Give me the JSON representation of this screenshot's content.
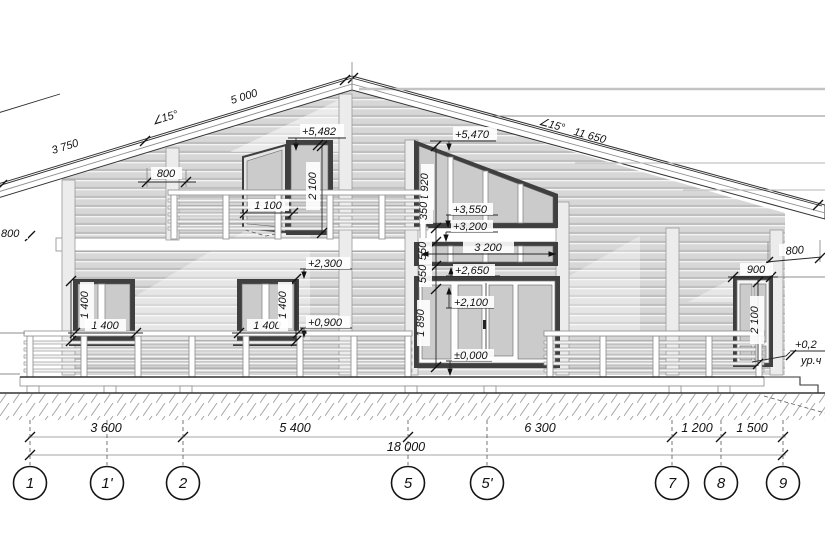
{
  "roof_dims": {
    "left_segment": "3 750",
    "left_angle": "∠15°",
    "left_slope": "5 000",
    "right_angle": "∠15°",
    "right_slope": "11 650",
    "gable_overhang": "800",
    "left_edge_overhang": "800",
    "right_overhang": "800"
  },
  "levels": {
    "balcony_door_top": "+5,482",
    "gable_window_top": "+5,470",
    "band_top": "+3,550",
    "band_window_top": "+3,200",
    "band_window_bottom": "+2,650",
    "window2_top": "+2,300",
    "door_top": "+2,100",
    "window2_sill": "+0,900",
    "floor_zero": "±0,000",
    "terrace_level": "+0,2",
    "terrace_level_note": "ур.ч"
  },
  "sizes": {
    "balcony_door_width": "1 100",
    "balcony_door_height": "2 100",
    "gable_window_height": "1 920",
    "band_gap": "350",
    "band_window_width": "3 200",
    "band_window_height": "550",
    "door_head_gap": "550",
    "door_section_height": "1 890",
    "window1_width": "1 400",
    "window1_height": "1 400",
    "window2_width": "1 400",
    "window2_height": "1 400",
    "right_door_width": "900",
    "right_door_height": "2 100"
  },
  "grid": {
    "bubbles": [
      "1",
      "1'",
      "2",
      "5",
      "5'",
      "7",
      "8",
      "9"
    ],
    "segments": [
      "3 600",
      "5 400",
      "6 300",
      "1 200",
      "1 500"
    ],
    "total": "18 000"
  }
}
